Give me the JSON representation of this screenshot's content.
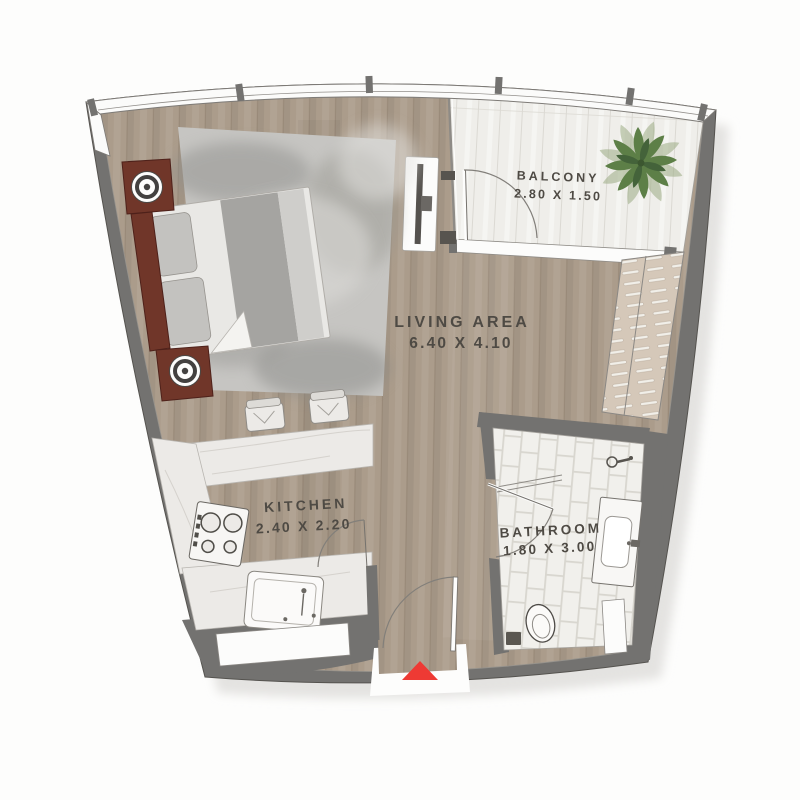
{
  "rooms": {
    "living": {
      "name": "LIVING AREA",
      "dims": "6.40 X 4.10"
    },
    "kitchen": {
      "name": "KITCHEN",
      "dims": "2.40 X 2.20"
    },
    "bathroom": {
      "name": "BATHROOM",
      "dims": "1.80 X 3.00"
    },
    "balcony": {
      "name": "BALCONY",
      "dims": "2.80 X 1.50"
    }
  },
  "colors": {
    "page": "#fdfdfc",
    "white": "#fcfcfb",
    "wall": "#737270",
    "outline": "#55534f",
    "floorWood": "#ab9c8b",
    "woodLine": "#998a79",
    "deck": "#efeeea",
    "deckLine": "#dbd9d3",
    "tile": "#f1f0ec",
    "tileLine": "#d8d6cf",
    "marble": "#eceae7",
    "marbleVein": "#cfccc7",
    "rug": "#c6c5c2",
    "bedBase": "#e9e8e5",
    "pillow": "#c3c2bf",
    "blanket": "#a5a4a1",
    "maroon": "#703629",
    "maroonDark": "#4e211a",
    "wardrobe": "#d5c8b9",
    "slat": "#f1efe9",
    "palm": "#5d7f47",
    "palmDark": "#44633a",
    "arrow": "#ee3a34",
    "text": "#4e4a44",
    "fixture": "#57544f",
    "shadow": "#e4e3e1"
  }
}
